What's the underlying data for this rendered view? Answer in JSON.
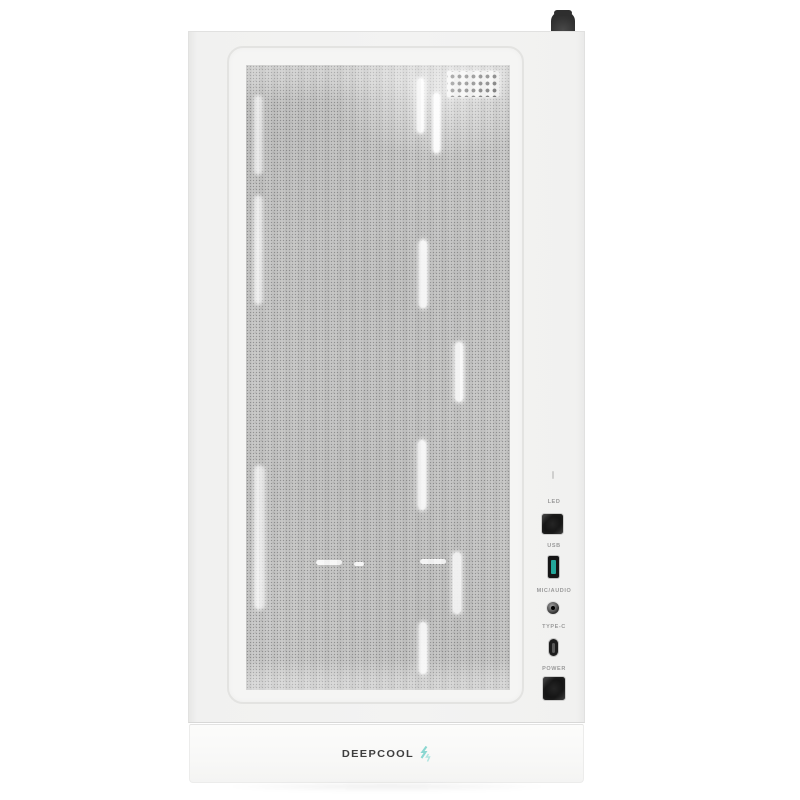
{
  "product": {
    "subject": "white mesh-front PC case, front view",
    "brand_visible": true
  },
  "io_panel": {
    "marker_icon": "small-dash-mark",
    "items": [
      {
        "label": "LED",
        "control": "square-button-icon"
      },
      {
        "label": "USB",
        "control": "usb-a-port-icon"
      },
      {
        "label": "MIC/AUDIO",
        "control": "audio-jack-icon"
      },
      {
        "label": "TYPE-C",
        "control": "usb-c-port-icon"
      },
      {
        "label": "POWER",
        "control": "square-button-icon"
      }
    ]
  },
  "brand": {
    "wordmark": "DEEPCOOL",
    "logo_icon": "deepcool-glyph"
  },
  "colors": {
    "usb_port_teal": "#23a79b",
    "logo_icon_teal": "#8bd7d1",
    "logo_icon_teal_light": "#b0e5e0",
    "button_black": "#141414",
    "case_body": "#f1f1f0",
    "background": "#ffffff"
  }
}
